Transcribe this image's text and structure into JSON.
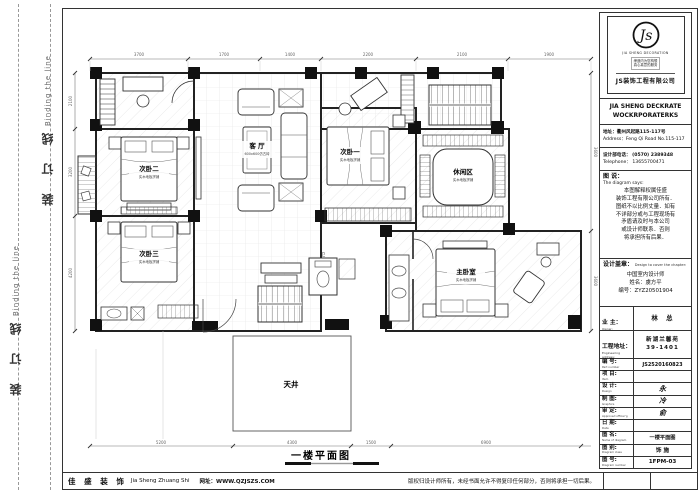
{
  "sheet": {
    "plan_title": "一楼平面图"
  },
  "binding": {
    "cn": "装 订 线",
    "en": "Binding the line"
  },
  "plan": {
    "rooms": {
      "cw2": {
        "name": "次卧二",
        "sub": "实木地板拼铺"
      },
      "cw3": {
        "name": "次卧三",
        "sub": "实木地板拼铺"
      },
      "cw1": {
        "name": "次卧一",
        "sub": "实木地板拼铺"
      },
      "keting": {
        "name": "客 厅",
        "sub": "600x600仿古砖"
      },
      "xiuxian": {
        "name": "休闲区",
        "sub": "实木地板拼铺"
      },
      "zhuwo": {
        "name": "主卧室",
        "sub": "实木地板拼铺"
      },
      "tianjing": {
        "name": "天井"
      },
      "wc": {
        "name": "卫"
      }
    },
    "dims": {
      "top": [
        "3700",
        "1700",
        "1400",
        "2200",
        "2100",
        "1900"
      ],
      "left": [
        "2100",
        "3200",
        "4200"
      ],
      "bottom": [
        "5200",
        "4300",
        "1500",
        "6900"
      ],
      "right": [
        "3600",
        "3600"
      ]
    }
  },
  "title_block": {
    "logo_caption": "JIA SHENG DECORATION",
    "slogan1": "缔造内为您构想",
    "slogan2": "真心真意的服务",
    "company_cn": "JS装饰工程有限公司",
    "company_en1": "JIA SHENG DECKRATE",
    "company_en2": "WOCKRPORATERKS",
    "address_cn": "地址：衢州风起路115-117号",
    "address_en": "Address：Feng Qi Road No.115-117",
    "phone_cn": "设计部电话： (0570) 2389348",
    "phone_en": "Telephone： 13655700471",
    "shuo_cn": "图 说：",
    "shuo_en": "The diagram says:",
    "shuo_l1": "本图解释权属佳盛",
    "shuo_l2": "装饰工程有限公司所有．",
    "shuo_l3": "图纸不以比例丈量．如有",
    "shuo_l4": "不详部分或与工程现场有",
    "shuo_l5": "矛盾请及时与本公司",
    "shuo_l6": "或设计师联系．否则",
    "shuo_l7": "将承担所有后果．",
    "stamp_cn": "设计盖章：",
    "stamp_en": "Design to cover the chapter:",
    "stamp_line1": "中国室内设计师",
    "stamp_line2": "姓名：虞方平",
    "stamp_line3": "编号：ZYZ20501904",
    "owner_cn": "业 主：",
    "owner_en": "Owner:",
    "owner_value": "林　总",
    "eng_cn": "工程地址：",
    "eng_en": "Engineering address:",
    "eng_value1": "新湖兰馨苑",
    "eng_value2": "39-1401",
    "rows": [
      {
        "cn": "编 号:",
        "en": "Part number",
        "value": "JS2520160823"
      },
      {
        "cn": "项 目:",
        "en": "Item",
        "value": ""
      },
      {
        "cn": "设 计:",
        "en": "Design",
        "value": "永"
      },
      {
        "cn": "制 图:",
        "en": "Graphics",
        "value": "冷"
      },
      {
        "cn": "审 定:",
        "en": "Approved officer'g",
        "value": "俞"
      },
      {
        "cn": "日 期:",
        "en": "Date",
        "value": ""
      },
      {
        "cn": "图 名:",
        "en": "Name of diagram",
        "value": "一楼平面图"
      },
      {
        "cn": "图 别:",
        "en": "Diagram class",
        "value": "饰 施"
      },
      {
        "cn": "图 号:",
        "en": "Diagram number",
        "value": "1FPM-03"
      }
    ]
  },
  "footer": {
    "brand_cn": "佳 盛 装 饰",
    "brand_en": "Jia Sheng Zhuang Shi",
    "site": "网址：WWW.QZJSZS.COM",
    "copyright": "版权归设计师所有，未经书面允许不得复印任何部分，否则将承担一切后果。"
  }
}
